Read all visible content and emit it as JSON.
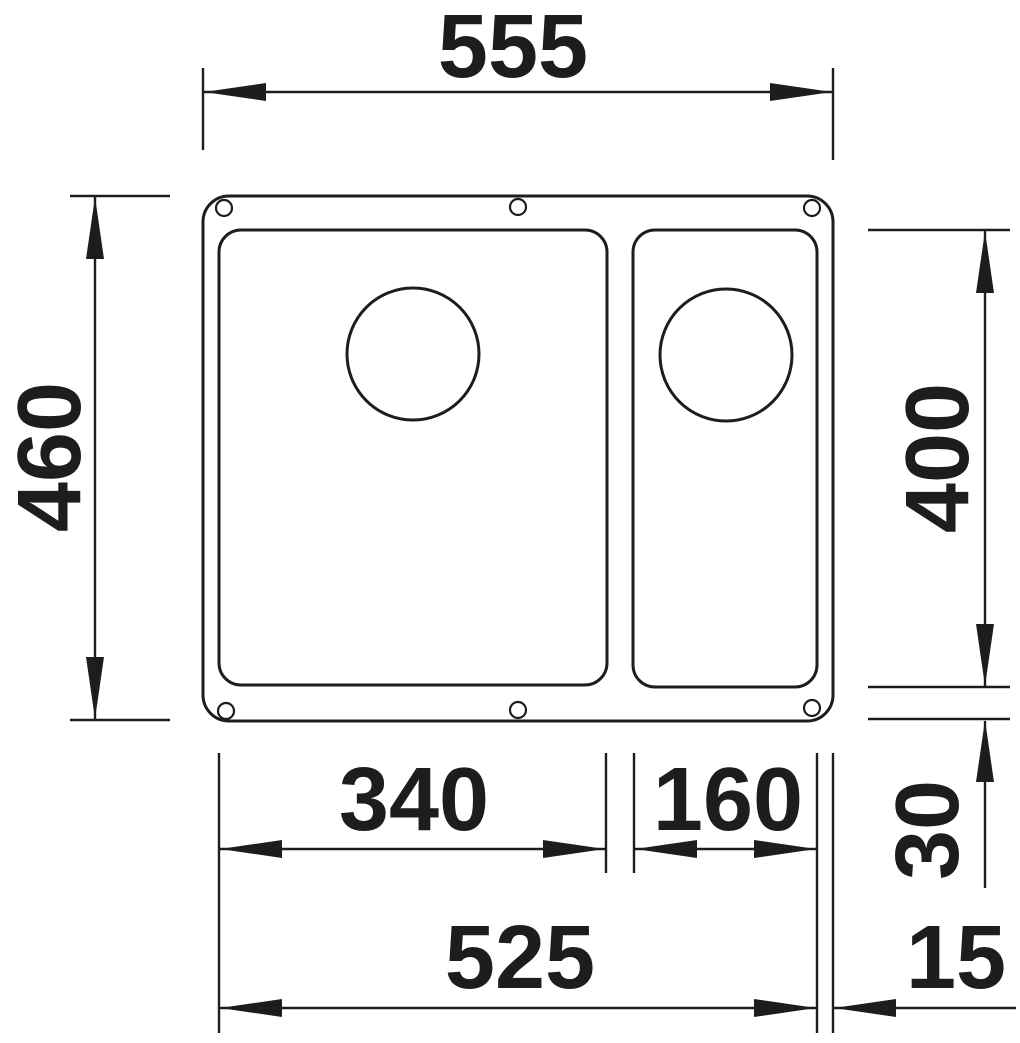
{
  "diagram": {
    "type": "technical-drawing",
    "subject": "Undermount kitchen sink with main bowl and half bowl, top view with dimensions",
    "unit": "mm",
    "labels": {
      "overall_width": "555",
      "overall_depth": "460",
      "bowl_depth": "400",
      "main_bowl_width": "340",
      "half_bowl_width": "160",
      "rear_offset": "30",
      "bowls_span_width": "525",
      "side_offset": "15"
    },
    "colors": {
      "line": "#1d1d1b",
      "background": "#ffffff"
    }
  }
}
